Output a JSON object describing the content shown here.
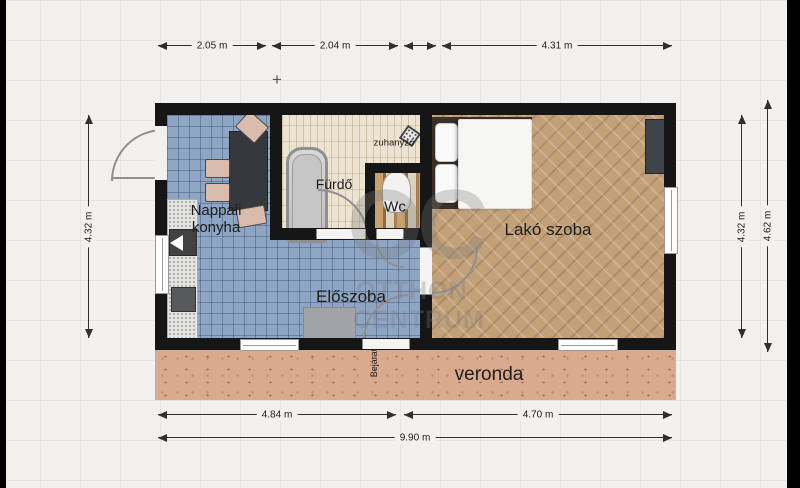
{
  "rooms": {
    "kitchen_line1": "Nappali",
    "kitchen_line2": "konyha",
    "bathroom": "Fürdő",
    "shower": "zuhanyzó",
    "wc": "Wc",
    "living_room": "Lakó szoba",
    "hallway": "Előszoba",
    "entrance": "Bejárat",
    "veranda": "veronda"
  },
  "dimensions": {
    "top_1": "2.05 m",
    "top_2": "2.04 m",
    "top_3": "4.31 m",
    "bottom_1": "4.84 m",
    "bottom_2": "4.70 m",
    "total_width": "9.90 m",
    "left": "4.32 m",
    "right_inner": "4.32 m",
    "right_outer": "4.62 m"
  },
  "watermark": {
    "initials": "OC",
    "name_line1": "OTTHON",
    "name_line2": "CENTRUM"
  },
  "marker": {
    "plus": "+"
  },
  "colors": {
    "wall": "#161616",
    "tile_blue": "#8fa5c4",
    "bath_cream": "#ece4d1",
    "wood_tan": "#c2a078",
    "veranda_terracotta": "#d9aa8e"
  }
}
